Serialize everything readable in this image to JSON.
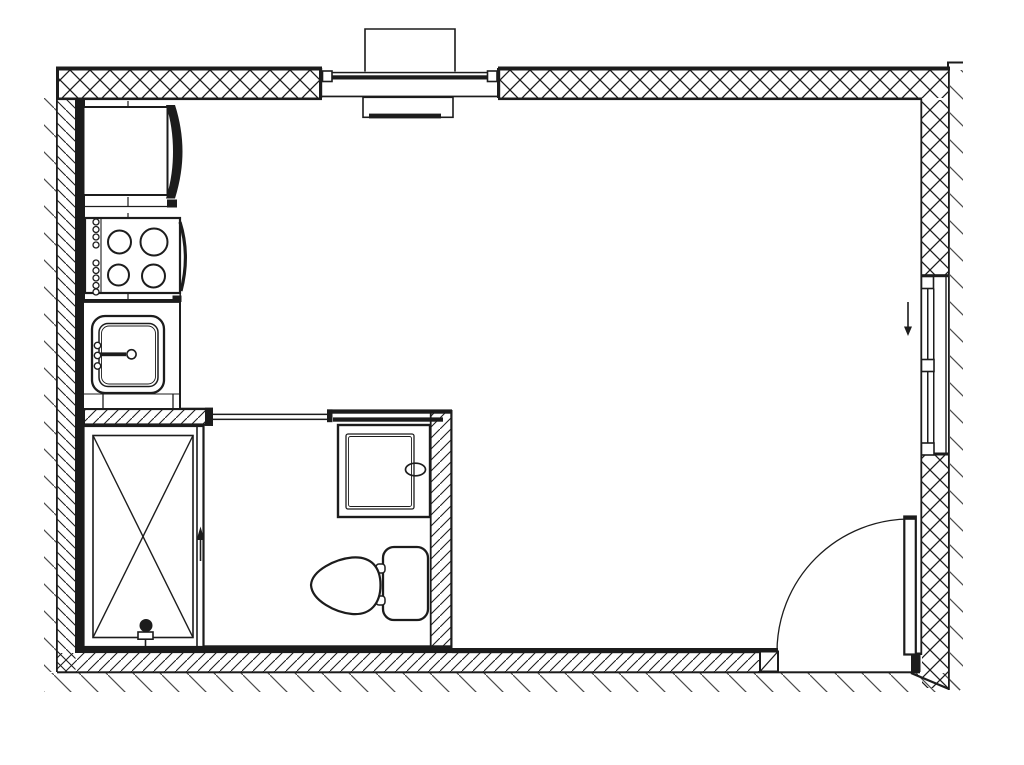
{
  "drawing": {
    "type": "architectural-floor-plan",
    "subject": "studio-apartment-plan-view"
  },
  "colors": {
    "background": "#ffffff",
    "line": "#1c1c1c",
    "tick_hatch": "#4a4a4a"
  },
  "rooms": [
    {
      "name": "kitchen-strip"
    },
    {
      "name": "bathroom"
    },
    {
      "name": "main-room"
    }
  ],
  "fixtures": [
    {
      "name": "refrigerator"
    },
    {
      "name": "stove",
      "burners": 4
    },
    {
      "name": "kitchen-sink",
      "faucet": true
    },
    {
      "name": "shower-tray",
      "drain": true
    },
    {
      "name": "toilet",
      "parts": [
        "bowl",
        "tank",
        "hinges"
      ]
    },
    {
      "name": "washbasin-cabinet",
      "knob": true
    },
    {
      "name": "top-window",
      "sill_boxes": 2
    },
    {
      "name": "right-window",
      "sashes": 2
    },
    {
      "name": "entry-door",
      "swing": "quarter-arc"
    }
  ],
  "annotations": [
    {
      "name": "down-arrow",
      "location": "right-window"
    },
    {
      "name": "up-arrow",
      "location": "shower-partition"
    },
    {
      "name": "dashed-centerline",
      "location": "kitchen-strip"
    }
  ]
}
